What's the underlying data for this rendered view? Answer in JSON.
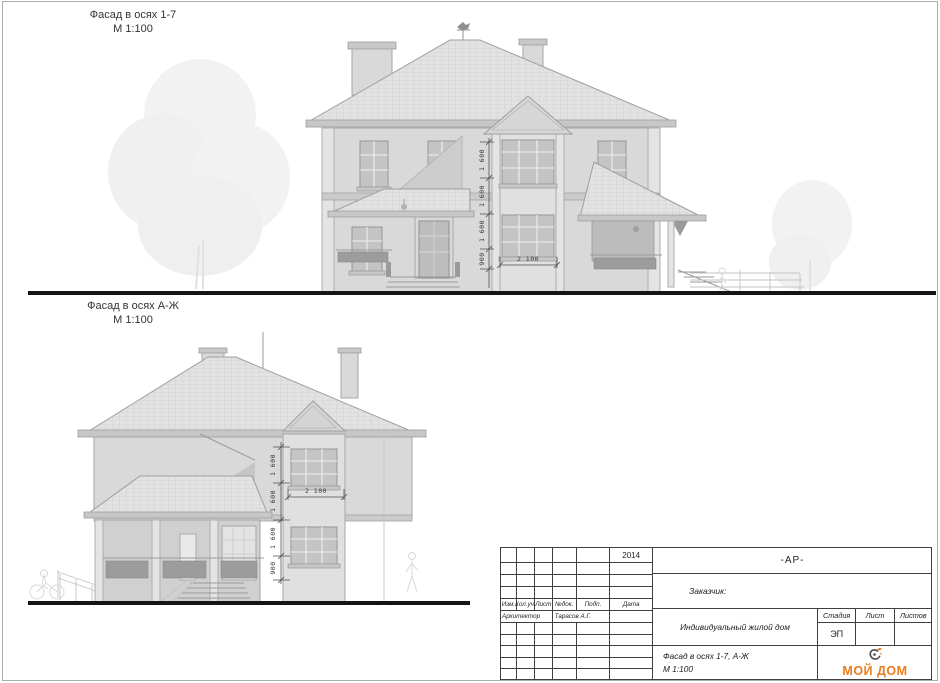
{
  "drawings": [
    {
      "title": "Фасад в осях 1-7",
      "scale": "М 1:100",
      "dims_vertical": [
        "1 600",
        "1 600",
        "1 600",
        "900"
      ],
      "dim_horizontal": "2 100"
    },
    {
      "title": "Фасад в осях А-Ж",
      "scale": "М 1:100",
      "dims_vertical": [
        "1 600",
        "1 600",
        "1 600",
        "900"
      ],
      "dim_horizontal": "2 100"
    }
  ],
  "title_block": {
    "year": "2014",
    "doc_code": "-АР-",
    "customer_label": "Заказчик:",
    "columns": [
      "Изм.",
      "Кол.уч.",
      "Лист",
      "№док.",
      "Подп.",
      "Дата"
    ],
    "role": "Архитектор",
    "name": "Тарасов А.Г.",
    "project": "Индивидуальный жилой дом",
    "stage_label": "Стадия",
    "sheet_label": "Лист",
    "sheets_label": "Листов",
    "stage_value": "ЭП",
    "sheet_name": "Фасад в осях 1-7, А-Ж",
    "sheet_scale": "М 1:100",
    "logo": {
      "text": "МОЙ ДОМ",
      "color": "#ee7c1b",
      "icon": "bird-swirl-icon"
    }
  }
}
